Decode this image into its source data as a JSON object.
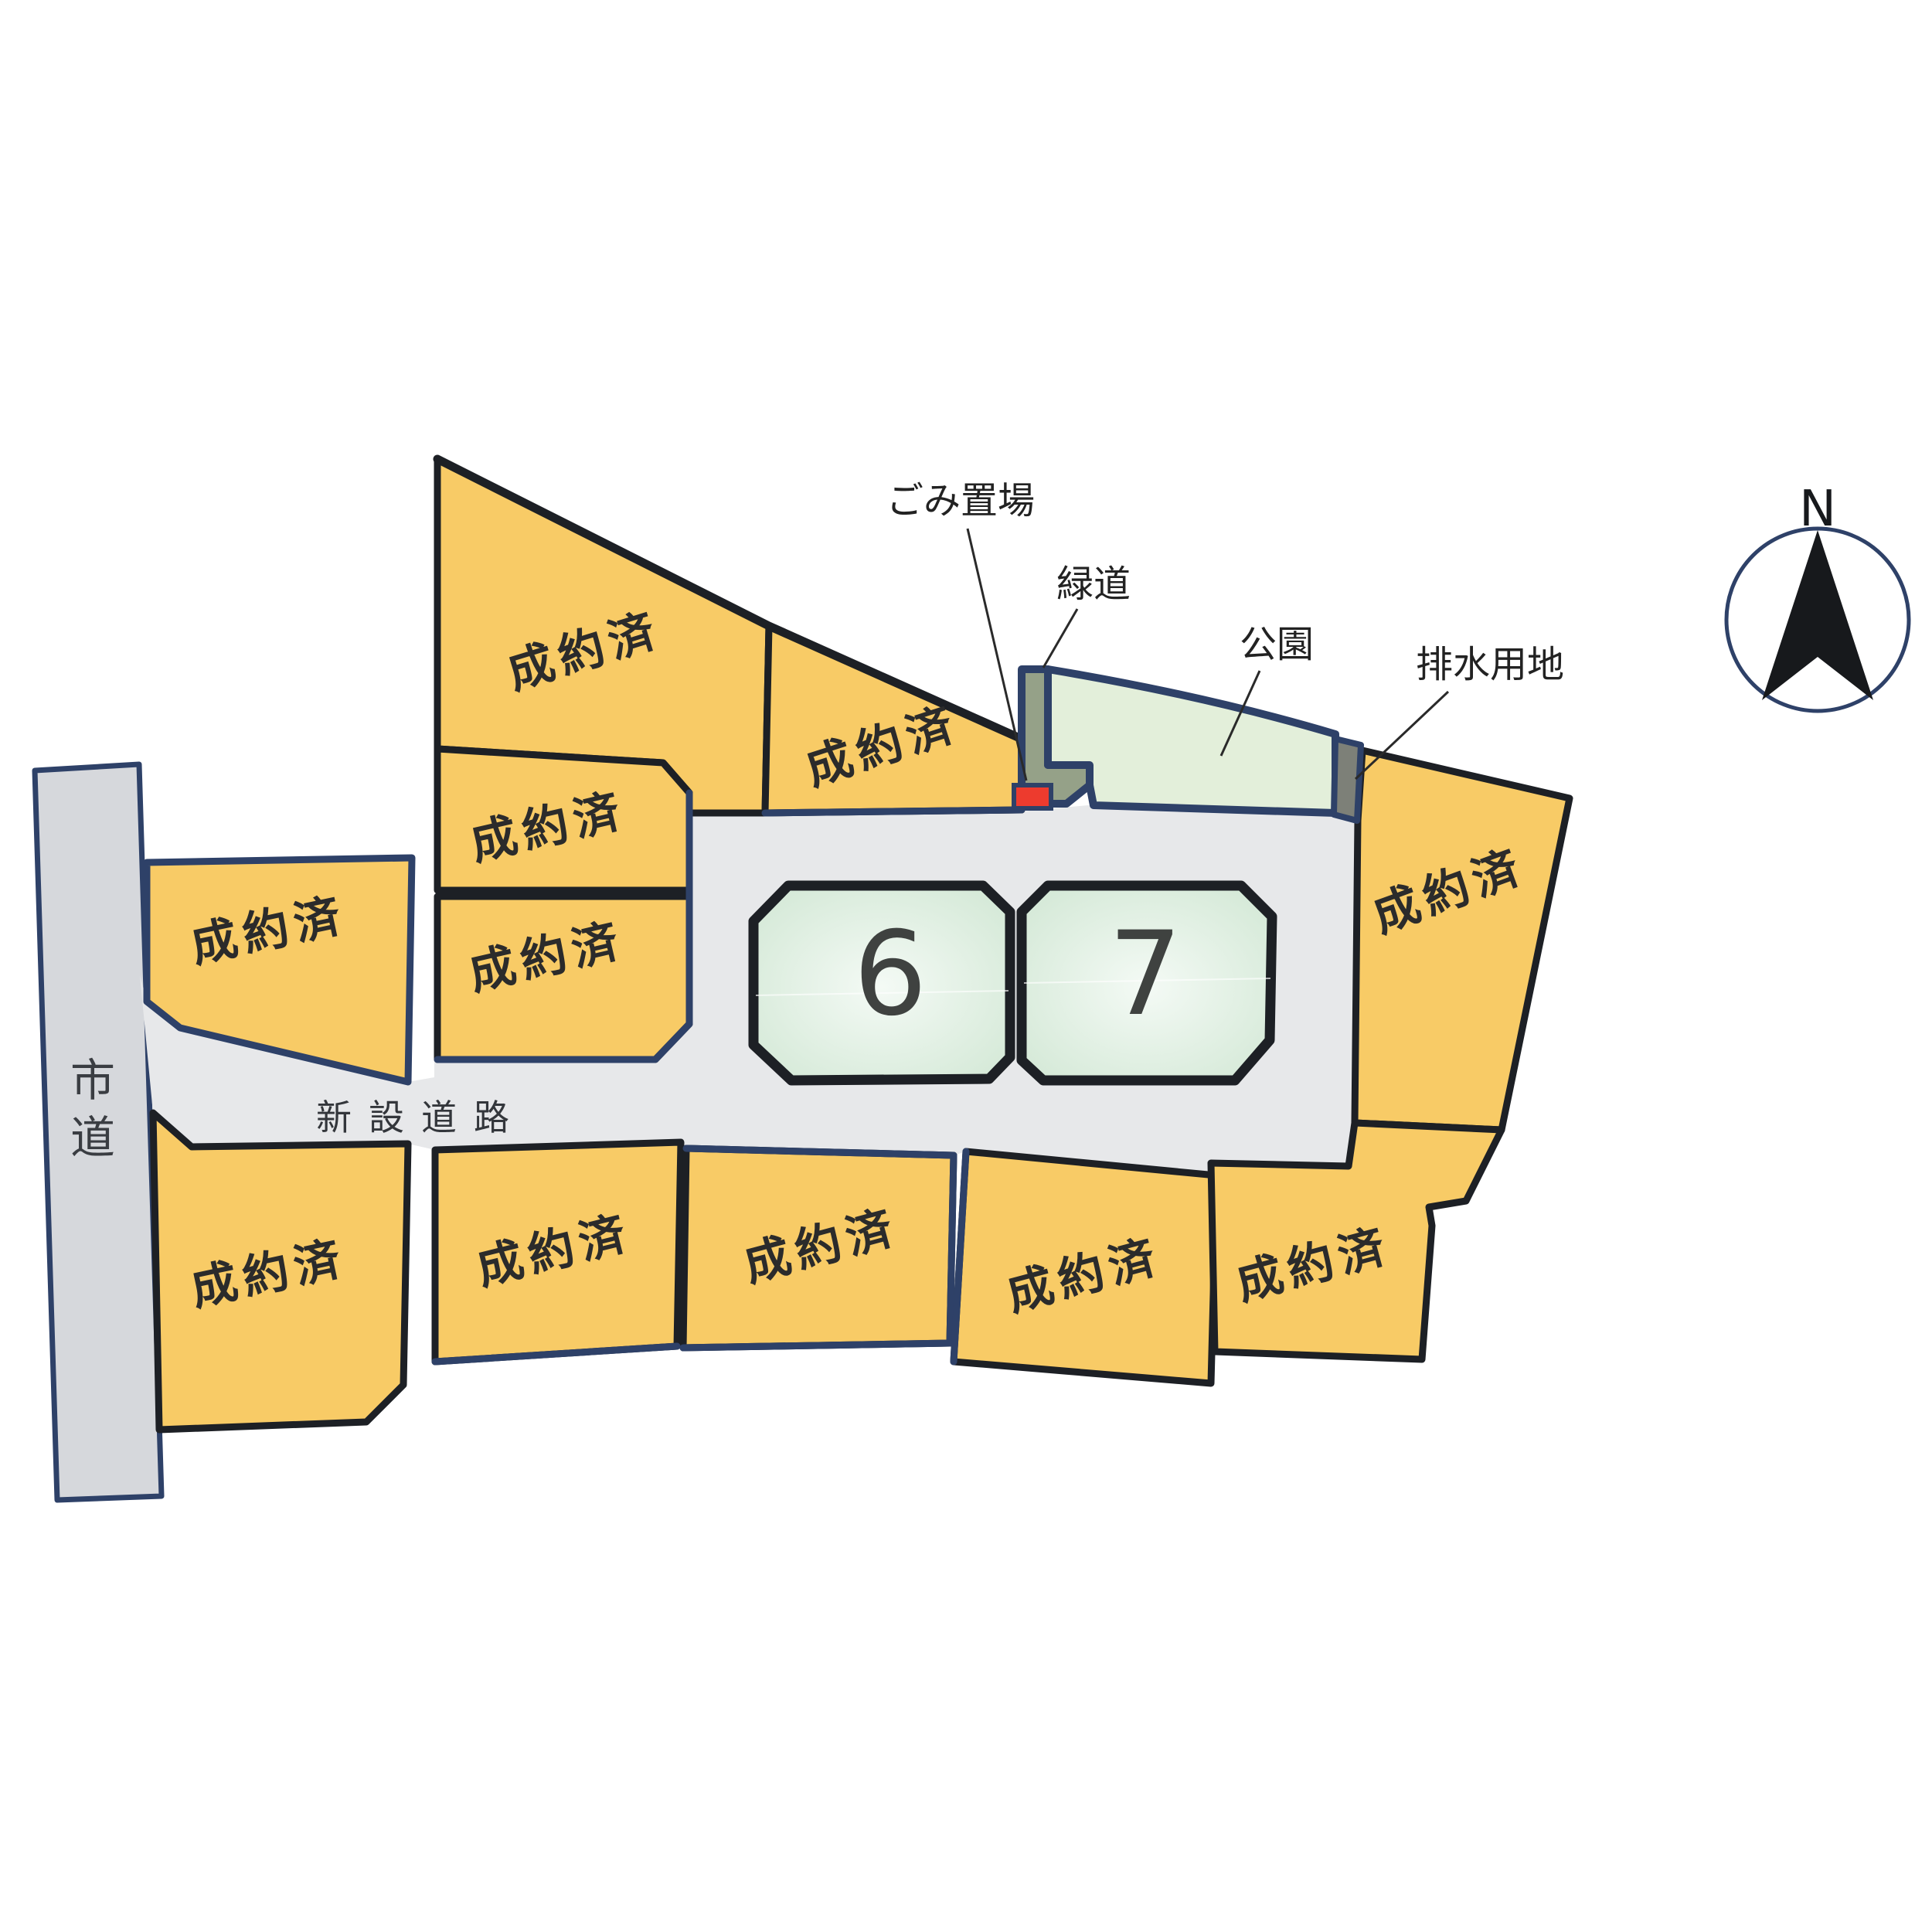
{
  "map": {
    "type": "real-estate-subdivision-plot-map",
    "background": "#ffffff"
  },
  "lots": {
    "sold_label": "成約済",
    "sold_count": 11,
    "available": [
      {
        "id": "lot-6",
        "number": "6"
      },
      {
        "id": "lot-7",
        "number": "7"
      }
    ]
  },
  "roads": {
    "city_road_label": "市道",
    "new_road_label": "新設道路"
  },
  "features": {
    "garbage": {
      "label": "ごみ置場"
    },
    "greenway": {
      "label": "緑道"
    },
    "park": {
      "label": "公園"
    },
    "drainage": {
      "label": "排水用地"
    }
  },
  "compass": {
    "north_label": "N"
  },
  "colors": {
    "sold_lot_fill": "#f8cb66",
    "available_lot_edge": "#cfe6d2",
    "available_lot_center": "#f4faf5",
    "road_fill": "#e7e8ea",
    "city_road_fill": "#d6d8dc",
    "park_fill": "#e3efda",
    "greenway_fill": "#95a188",
    "drainage_fill": "#7d8078",
    "garbage_marker_fill": "#ed3b2e",
    "border_black": "#1d2025",
    "border_navy": "#2e4168",
    "label_text": "#2b2b2b"
  }
}
